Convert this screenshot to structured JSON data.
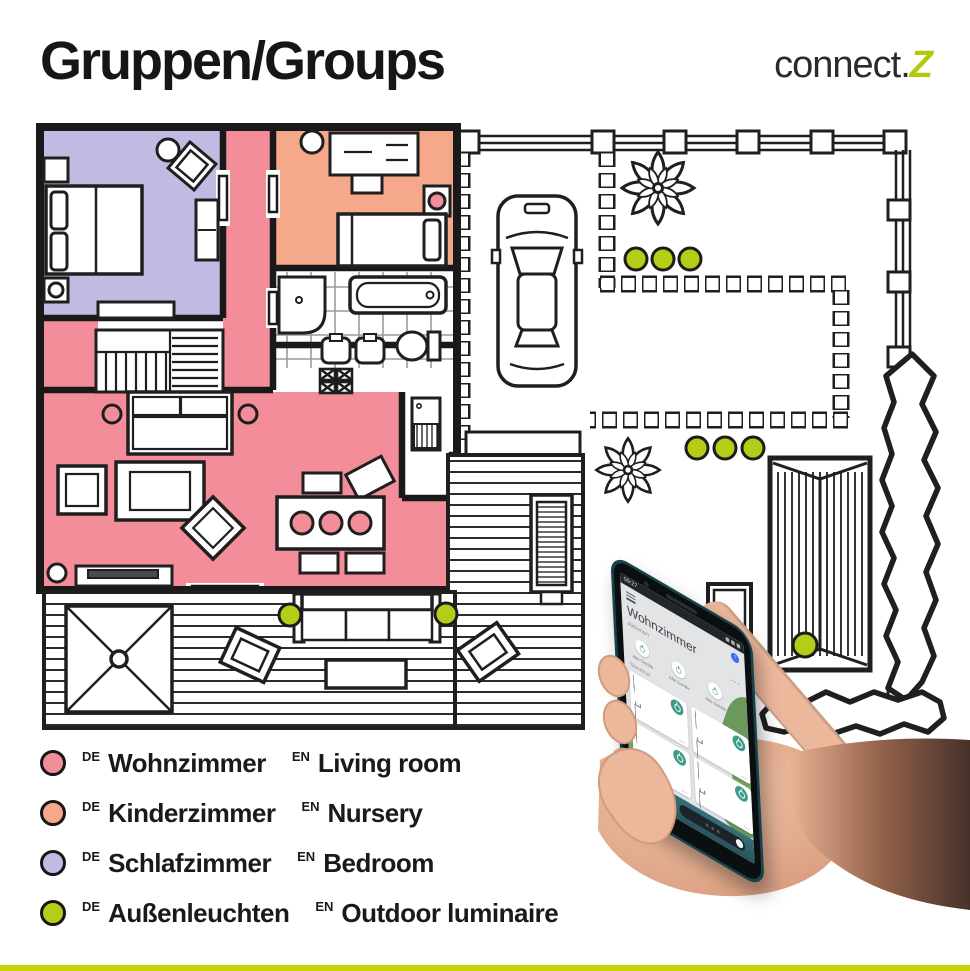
{
  "header": {
    "title": "Gruppen/Groups",
    "brand_prefix": "connect.",
    "brand_suffix": "Z"
  },
  "legend": {
    "items": [
      {
        "de_tag": "DE",
        "de": "Wohnzimmer",
        "en_tag": "EN",
        "en": "Living room",
        "color": "#f28d99"
      },
      {
        "de_tag": "DE",
        "de": "Kinderzimmer",
        "en_tag": "EN",
        "en": "Nursery",
        "color": "#f6a88b"
      },
      {
        "de_tag": "DE",
        "de": "Schlafzimmer",
        "en_tag": "EN",
        "en": "Bedroom",
        "color": "#c2bae3"
      },
      {
        "de_tag": "DE",
        "de": "Außenleuchten",
        "en_tag": "EN",
        "en": "Outdoor luminaire",
        "color": "#b5cd17"
      }
    ]
  },
  "phone": {
    "status_time": "09:27",
    "app_title": "Wohnzimmer",
    "sections": {
      "actions": "Aktionen",
      "shortcut": "Shortcut"
    },
    "action_buttons": [
      {
        "label": "Alle Geräte"
      },
      {
        "label": "Alle Geräte"
      },
      {
        "label": "Alle Geräte"
      }
    ],
    "device_tiles": [
      {
        "name": "Deckenleuchte",
        "room": "Wohnzimmer"
      },
      {
        "name": "LED Stripe",
        "room": "Wohnzimmer"
      },
      {
        "name": "Stehleuchte",
        "room": "Wohnzimmer"
      },
      {
        "name": "Tischleuchte",
        "room": "Wohnzimmer"
      }
    ],
    "more_label": "...",
    "tile_more_label": "..."
  },
  "colors": {
    "room_pink": "#f28d99",
    "room_orange": "#f6a88b",
    "room_purple": "#c2bae3",
    "light_green": "#b5cd17",
    "brand_green": "#b4c90e",
    "accent_teal": "#3f9c8c",
    "bottom_bar": "#c9d400"
  }
}
